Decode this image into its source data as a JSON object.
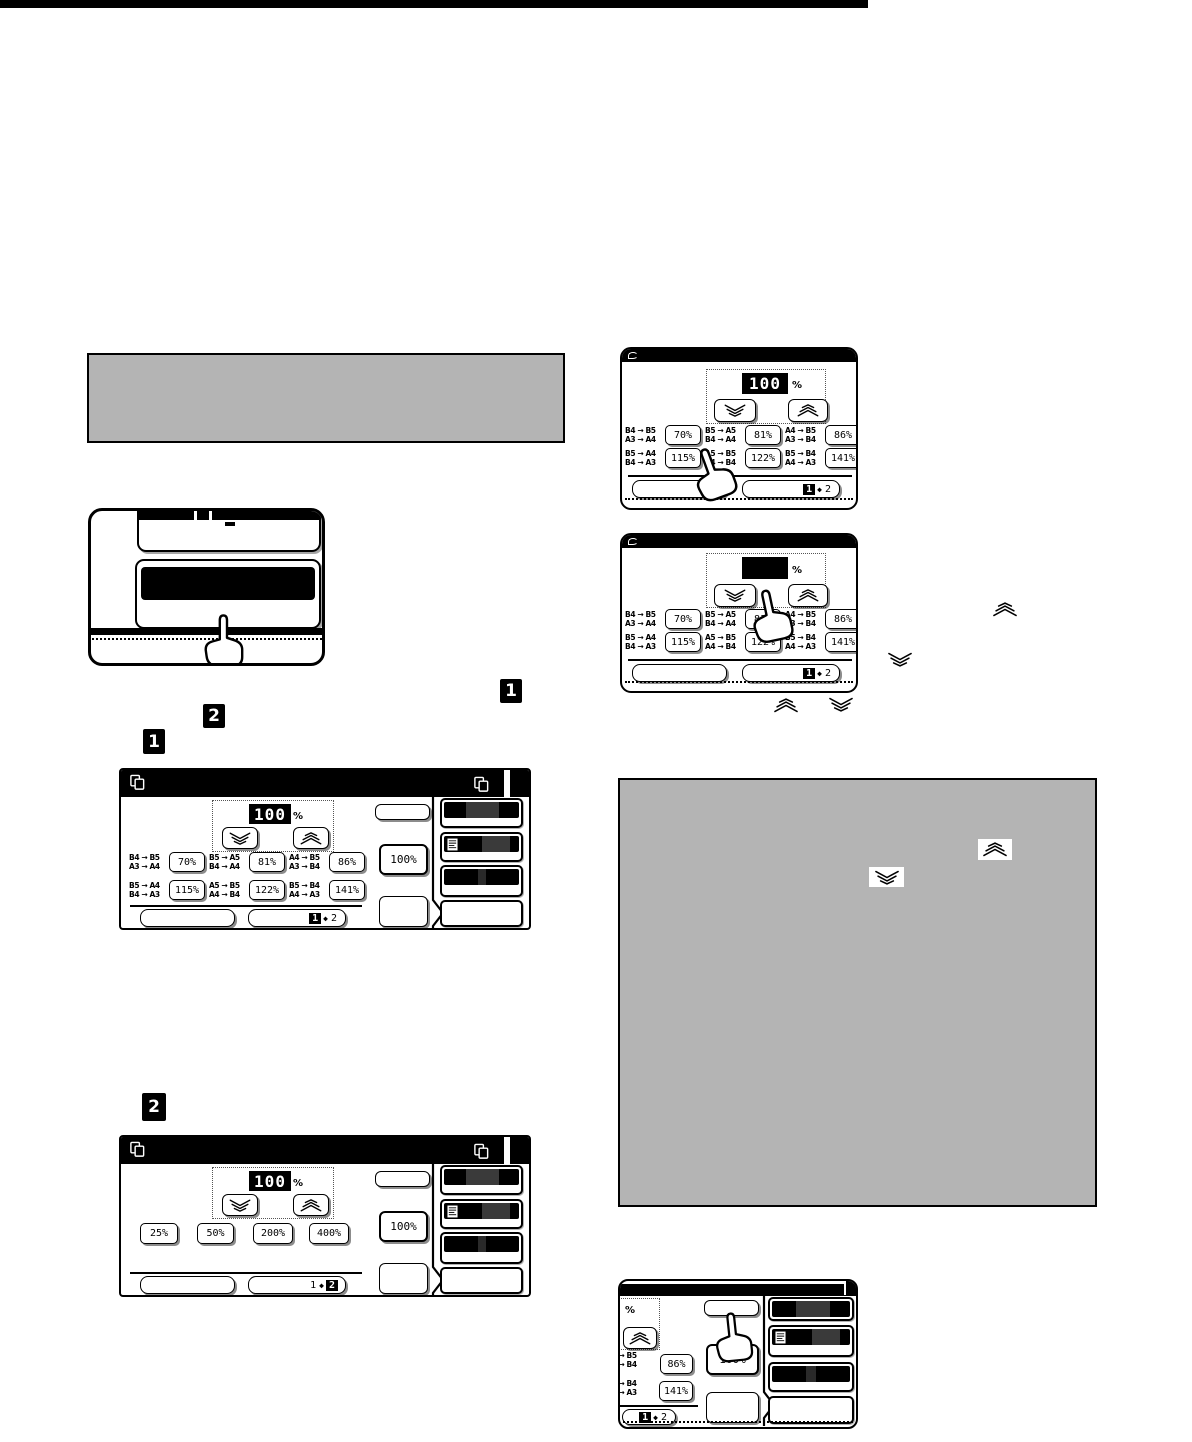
{
  "colors": {
    "note_bg": "#b4b4b4",
    "screen_bar": "#000000",
    "bar_segment": "#3a3a3a"
  },
  "display": {
    "value": "100",
    "unit": "%",
    "blank": ""
  },
  "ab_presets": [
    {
      "size_top": "B4 → B5",
      "size_bottom": "A3 → A4",
      "ratio": "70%"
    },
    {
      "size_top": "B5 → A5",
      "size_bottom": "B4 → A4",
      "ratio": "81%"
    },
    {
      "size_top": "A4 → B5",
      "size_bottom": "A3 → B4",
      "ratio": "86%"
    },
    {
      "size_top": "B5 → A4",
      "size_bottom": "B4 → A3",
      "ratio": "115%"
    },
    {
      "size_top": "A5 → B5",
      "size_bottom": "A4 → B4",
      "ratio": "122%"
    },
    {
      "size_top": "B5 → B4",
      "size_bottom": "A4 → A3",
      "ratio": "141%"
    }
  ],
  "fixed_presets": [
    {
      "ratio": "25%"
    },
    {
      "ratio": "50%"
    },
    {
      "ratio": "200%"
    },
    {
      "ratio": "400%"
    }
  ],
  "buttons": {
    "full_size": "100%"
  },
  "page_toggle": {
    "first": "1",
    "separator": "◆",
    "second": "2"
  },
  "step_markers": {
    "one": "1",
    "two": "2"
  },
  "icons": {
    "zoom_down": "chevron-down-icon",
    "zoom_up": "chevron-up-icon",
    "screen_title_left": "copy-pages-icon",
    "screen_title_right": "copy-pages-icon",
    "sidebar_menu": "document-lines-icon",
    "hand": "pointing-hand-cursor"
  }
}
